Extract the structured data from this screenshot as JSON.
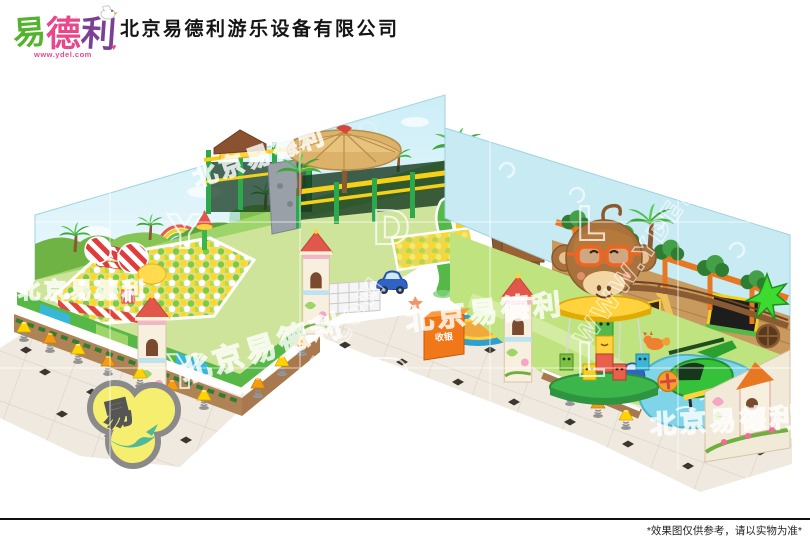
{
  "header": {
    "logo": {
      "chars": [
        {
          "text": "易",
          "color": "#54b32e"
        },
        {
          "text": "德",
          "color": "#e8478b"
        },
        {
          "text": "利",
          "color": "#7b3f98"
        }
      ],
      "url": "www.ydel.com"
    },
    "company_name": "北京易德利游乐设备有限公司"
  },
  "scene": {
    "cashier_sign": "收银",
    "watermarks": {
      "brand_cn": "北京易德利",
      "letters": [
        "Y",
        "D",
        "L"
      ],
      "url": "WWW.YDEL.COM"
    }
  },
  "footer": {
    "disclaimer": "*效果图仅供参考，请以实物为准*"
  },
  "colors": {
    "logo_green": "#54b32e",
    "logo_pink": "#e8478b",
    "logo_purple": "#7b3f98",
    "accent_green": "#3cb54a",
    "sky_blue": "#c8eaf3",
    "straw": "#d9b26a",
    "cashier_orange": "#f07818",
    "slide_yellow": "#f7d117",
    "floor_beige": "#efe9e0",
    "monkey_brown": "#a9713c"
  }
}
